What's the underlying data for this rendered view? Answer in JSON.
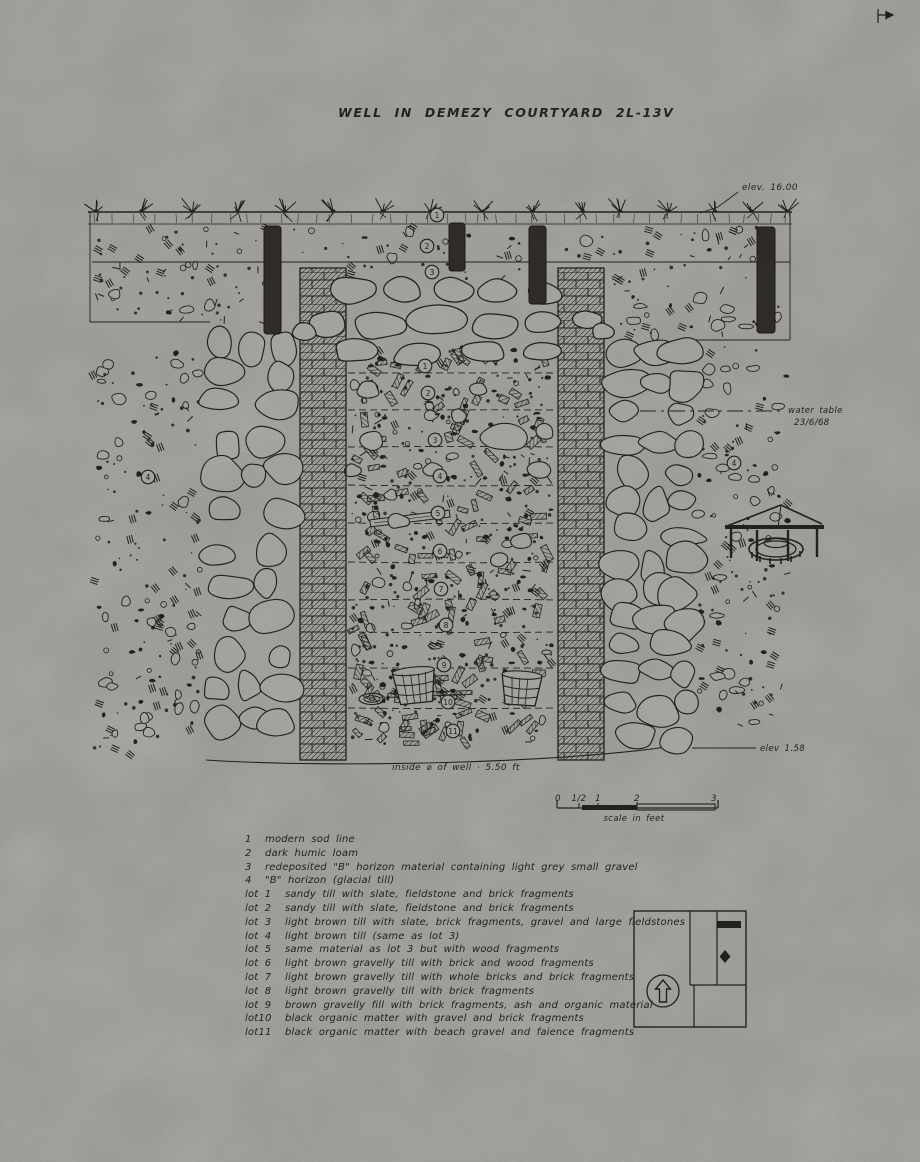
{
  "colors": {
    "paper": "#c7c5c0",
    "ink": "#2b2a26"
  },
  "figure": {
    "title": "WELL IN DEMEZY COURTYARD 2L-13V",
    "annotations": {
      "elev_top": "elev. 16.00",
      "water_table_l1": "water table",
      "water_table_l2": "23/6/68",
      "elev_bottom": "elev 1.58",
      "inside_diameter": "inside ⌀ of well · 5.50 ft"
    },
    "markers": {
      "layers": [
        "1",
        "2",
        "3"
      ],
      "b_horizon_left": "4",
      "b_horizon_right": "4",
      "lots": [
        "1",
        "2",
        "3",
        "4",
        "5",
        "6",
        "7",
        "8",
        "9",
        "10",
        "11"
      ]
    },
    "scale_bar": {
      "ticks": [
        "0",
        "1/2",
        "1",
        "2",
        "3"
      ],
      "caption": "scale in feet"
    }
  },
  "legend": {
    "items": [
      {
        "key": "1",
        "text": "modern sod line"
      },
      {
        "key": "2",
        "text": "dark humic loam"
      },
      {
        "key": "3",
        "text": "redeposited \"B\" horizon material containing light grey small gravel"
      },
      {
        "key": "4",
        "text": "\"B\" horizon (glacial till)"
      },
      {
        "key": "lot 1",
        "text": "sandy till with slate, fieldstone and brick fragments"
      },
      {
        "key": "lot 2",
        "text": "sandy till with slate, fieldstone and brick fragments"
      },
      {
        "key": "lot 3",
        "text": "light brown till with slate, brick fragments, gravel and large fieldstones"
      },
      {
        "key": "lot 4",
        "text": "light brown till (same as lot 3)"
      },
      {
        "key": "lot 5",
        "text": "same material as lot 3 but with wood fragments"
      },
      {
        "key": "lot 6",
        "text": "light brown gravelly till with brick and wood fragments"
      },
      {
        "key": "lot 7",
        "text": "light brown gravelly till with whole bricks and brick fragments"
      },
      {
        "key": "lot 8",
        "text": "light brown gravelly till with brick fragments"
      },
      {
        "key": "lot 9",
        "text": "brown gravelly fill with brick fragments, ash and organic material"
      },
      {
        "key": "lot10",
        "text": "black organic matter with gravel and brick fragments"
      },
      {
        "key": "lot11",
        "text": "black organic matter with beach gravel and faience fragments"
      }
    ]
  }
}
